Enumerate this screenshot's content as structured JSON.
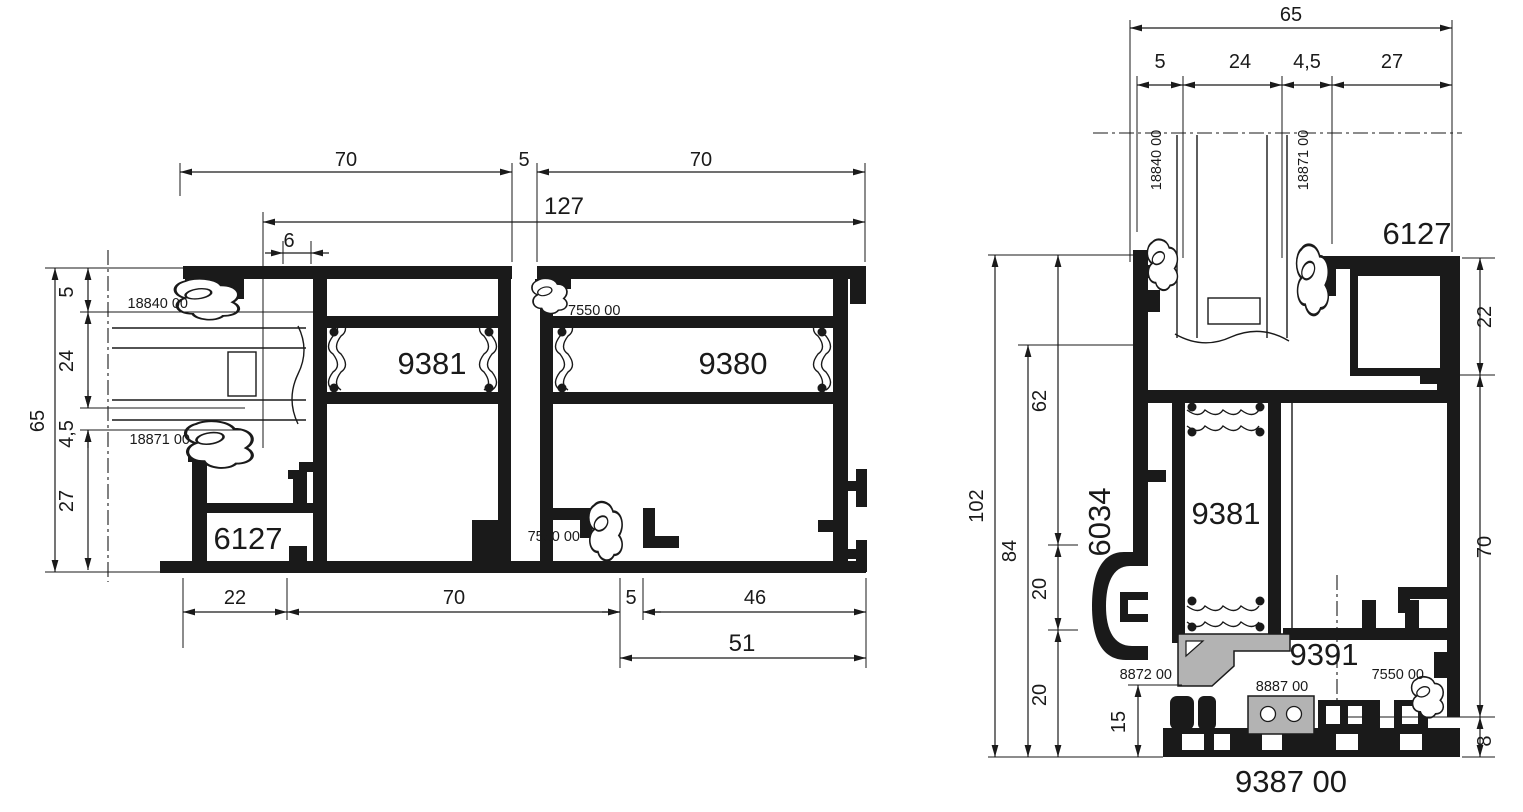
{
  "colors": {
    "ink": "#1a1a1a",
    "gray_part": "#b3b3b3",
    "background": "#ffffff"
  },
  "left_view": {
    "dims": {
      "top": [
        "70",
        "5",
        "70"
      ],
      "overall_width": "127",
      "offset": "6",
      "height_total": "65",
      "height_chain": [
        "5",
        "24",
        "4,5",
        "27"
      ],
      "bottom": [
        "22",
        "70",
        "5",
        "46"
      ],
      "bottom_overall": "51"
    },
    "parts": {
      "sash_left": "9381",
      "sash_right": "9380",
      "frame": "6127",
      "gasket_outer": "18840 00",
      "gasket_inner": "18871 00",
      "gasket_center_top": "7550 00",
      "gasket_center_bottom": "7550 00"
    }
  },
  "right_view": {
    "dims": {
      "width_total": "65",
      "width_chain": [
        "5",
        "24",
        "4,5",
        "27"
      ],
      "height_total": "102",
      "height_inner": "84",
      "height_chain": [
        "62",
        "20",
        "20"
      ],
      "threshold_height": "15",
      "right_chain": [
        "22",
        "70",
        "8"
      ]
    },
    "parts": {
      "frame_top": "6127",
      "jamb": "6034",
      "sash": "9381",
      "glazing_adapter": "9391",
      "threshold": "9387 00",
      "gasket_outer": "18840 00",
      "gasket_inner": "18871 00",
      "support_bracket": "8872 00",
      "connector": "8887 00",
      "gasket_bottom": "7550 00"
    }
  }
}
